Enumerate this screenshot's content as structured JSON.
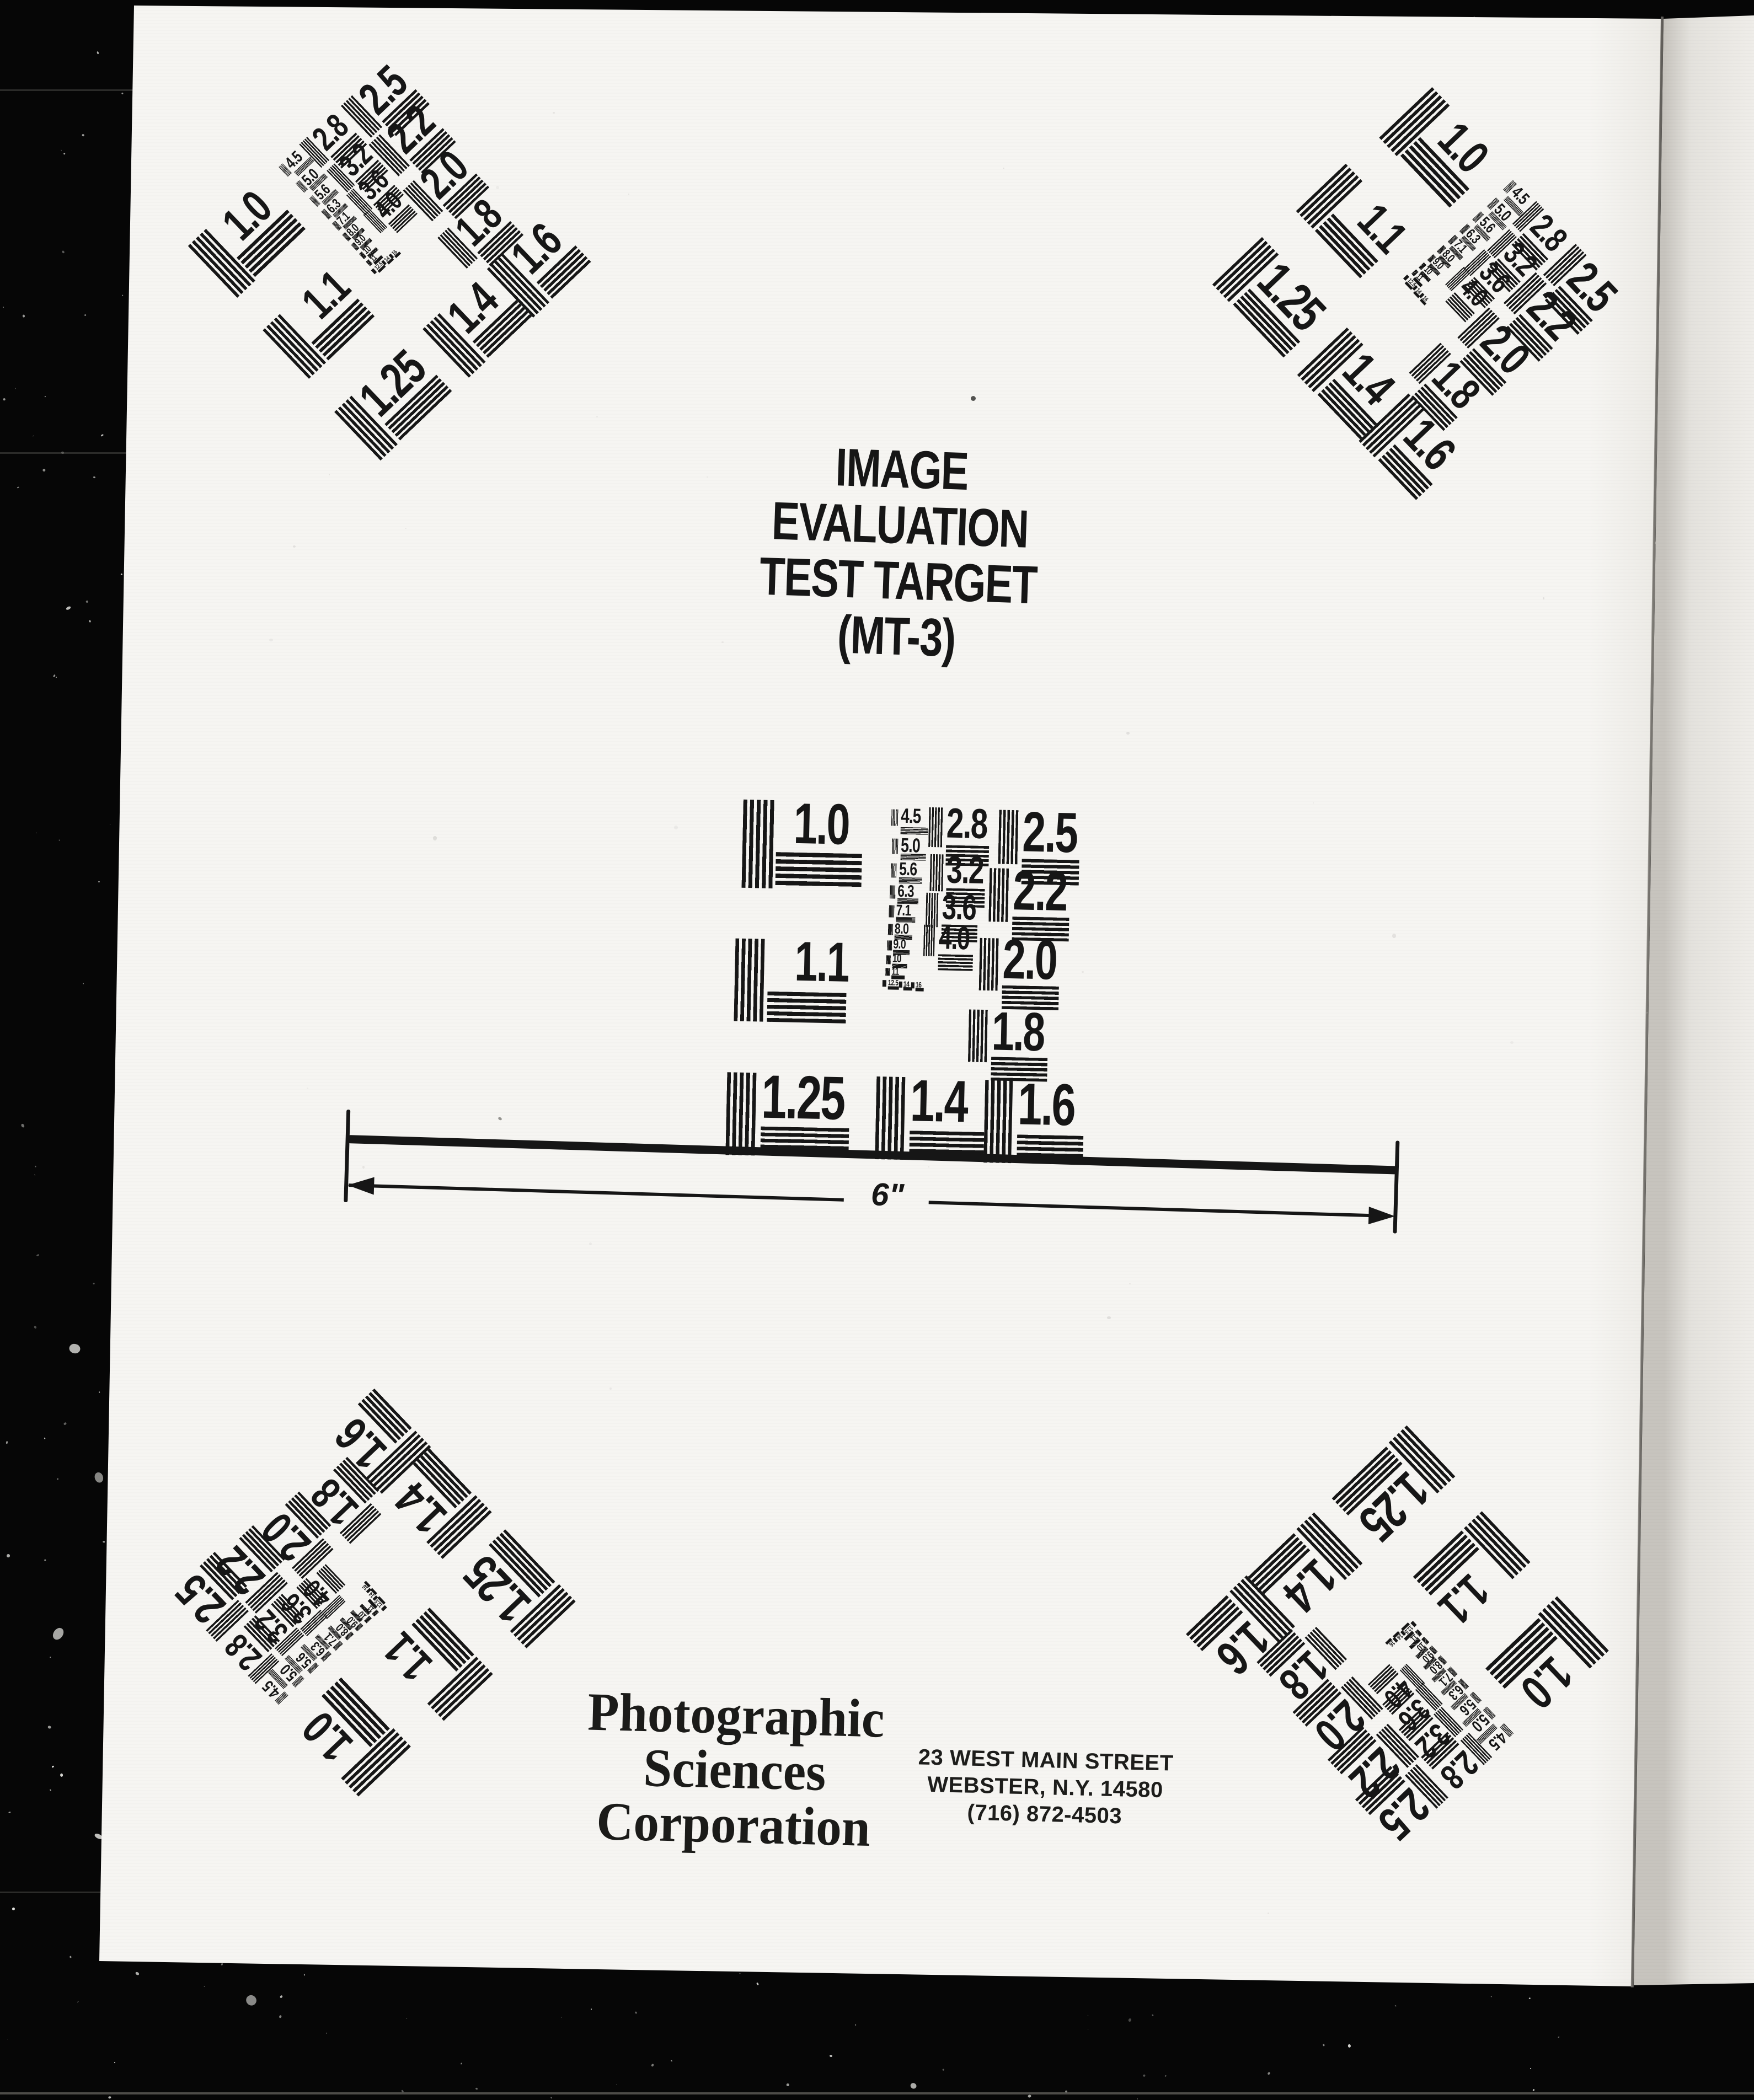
{
  "page": {
    "title_line1": "IMAGE EVALUATION",
    "title_line2": "TEST TARGET (MT-3)",
    "scale_label": "6\"",
    "company_line1": "Photographic",
    "company_line2": "Sciences",
    "company_line3": "Corporation",
    "address_line1": "23 WEST MAIN STREET",
    "address_line2": "WEBSTER, N.Y. 14580",
    "address_line3": "(716) 872-4503"
  },
  "target": {
    "patch_labels": [
      "1.0",
      "1.1",
      "1.25",
      "1.4",
      "1.6",
      "2.5",
      "2.2",
      "2.0",
      "1.8",
      "2.8",
      "3.2",
      "3.6",
      "4.0",
      "4.5",
      "5.0",
      "5.6",
      "6.3",
      "7.1",
      "8.0",
      "9.0",
      "10",
      "11",
      "12.5",
      "14",
      "16"
    ]
  },
  "colors": {
    "ink": "#161616",
    "paper": "#f6f5f1",
    "background": "#060606"
  }
}
